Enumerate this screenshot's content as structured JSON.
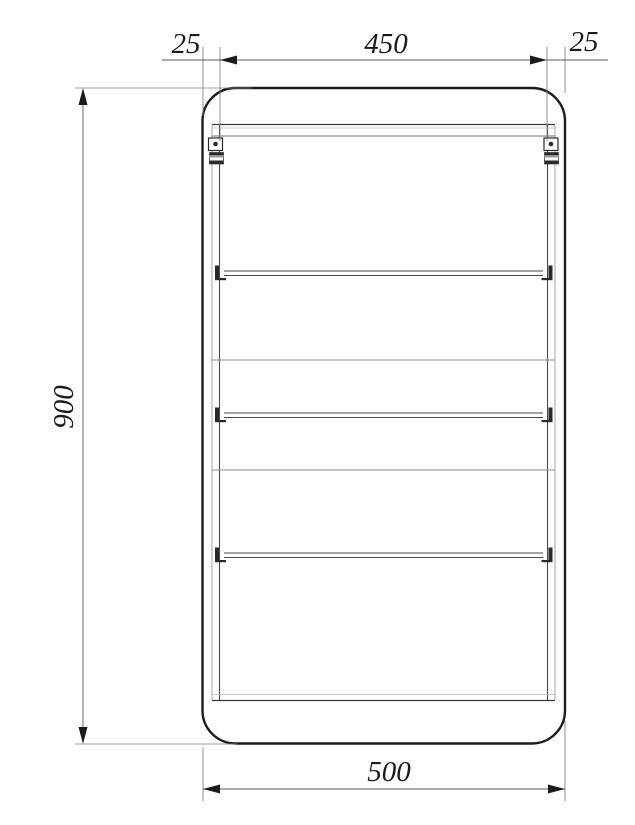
{
  "drawing": {
    "type": "furniture-front-elevation",
    "dimensions": {
      "top_left_offset": "25",
      "top_inner_width": "450",
      "top_right_offset": "25",
      "overall_height": "900",
      "overall_width": "500"
    },
    "colors": {
      "background": "#ffffff",
      "object_line": "#1c1c1c",
      "thin_object_line": "#9a9a9a",
      "dimension_line": "#5a5a5a",
      "arrow": "#1b1b1b",
      "text": "#1a1a1a"
    }
  }
}
